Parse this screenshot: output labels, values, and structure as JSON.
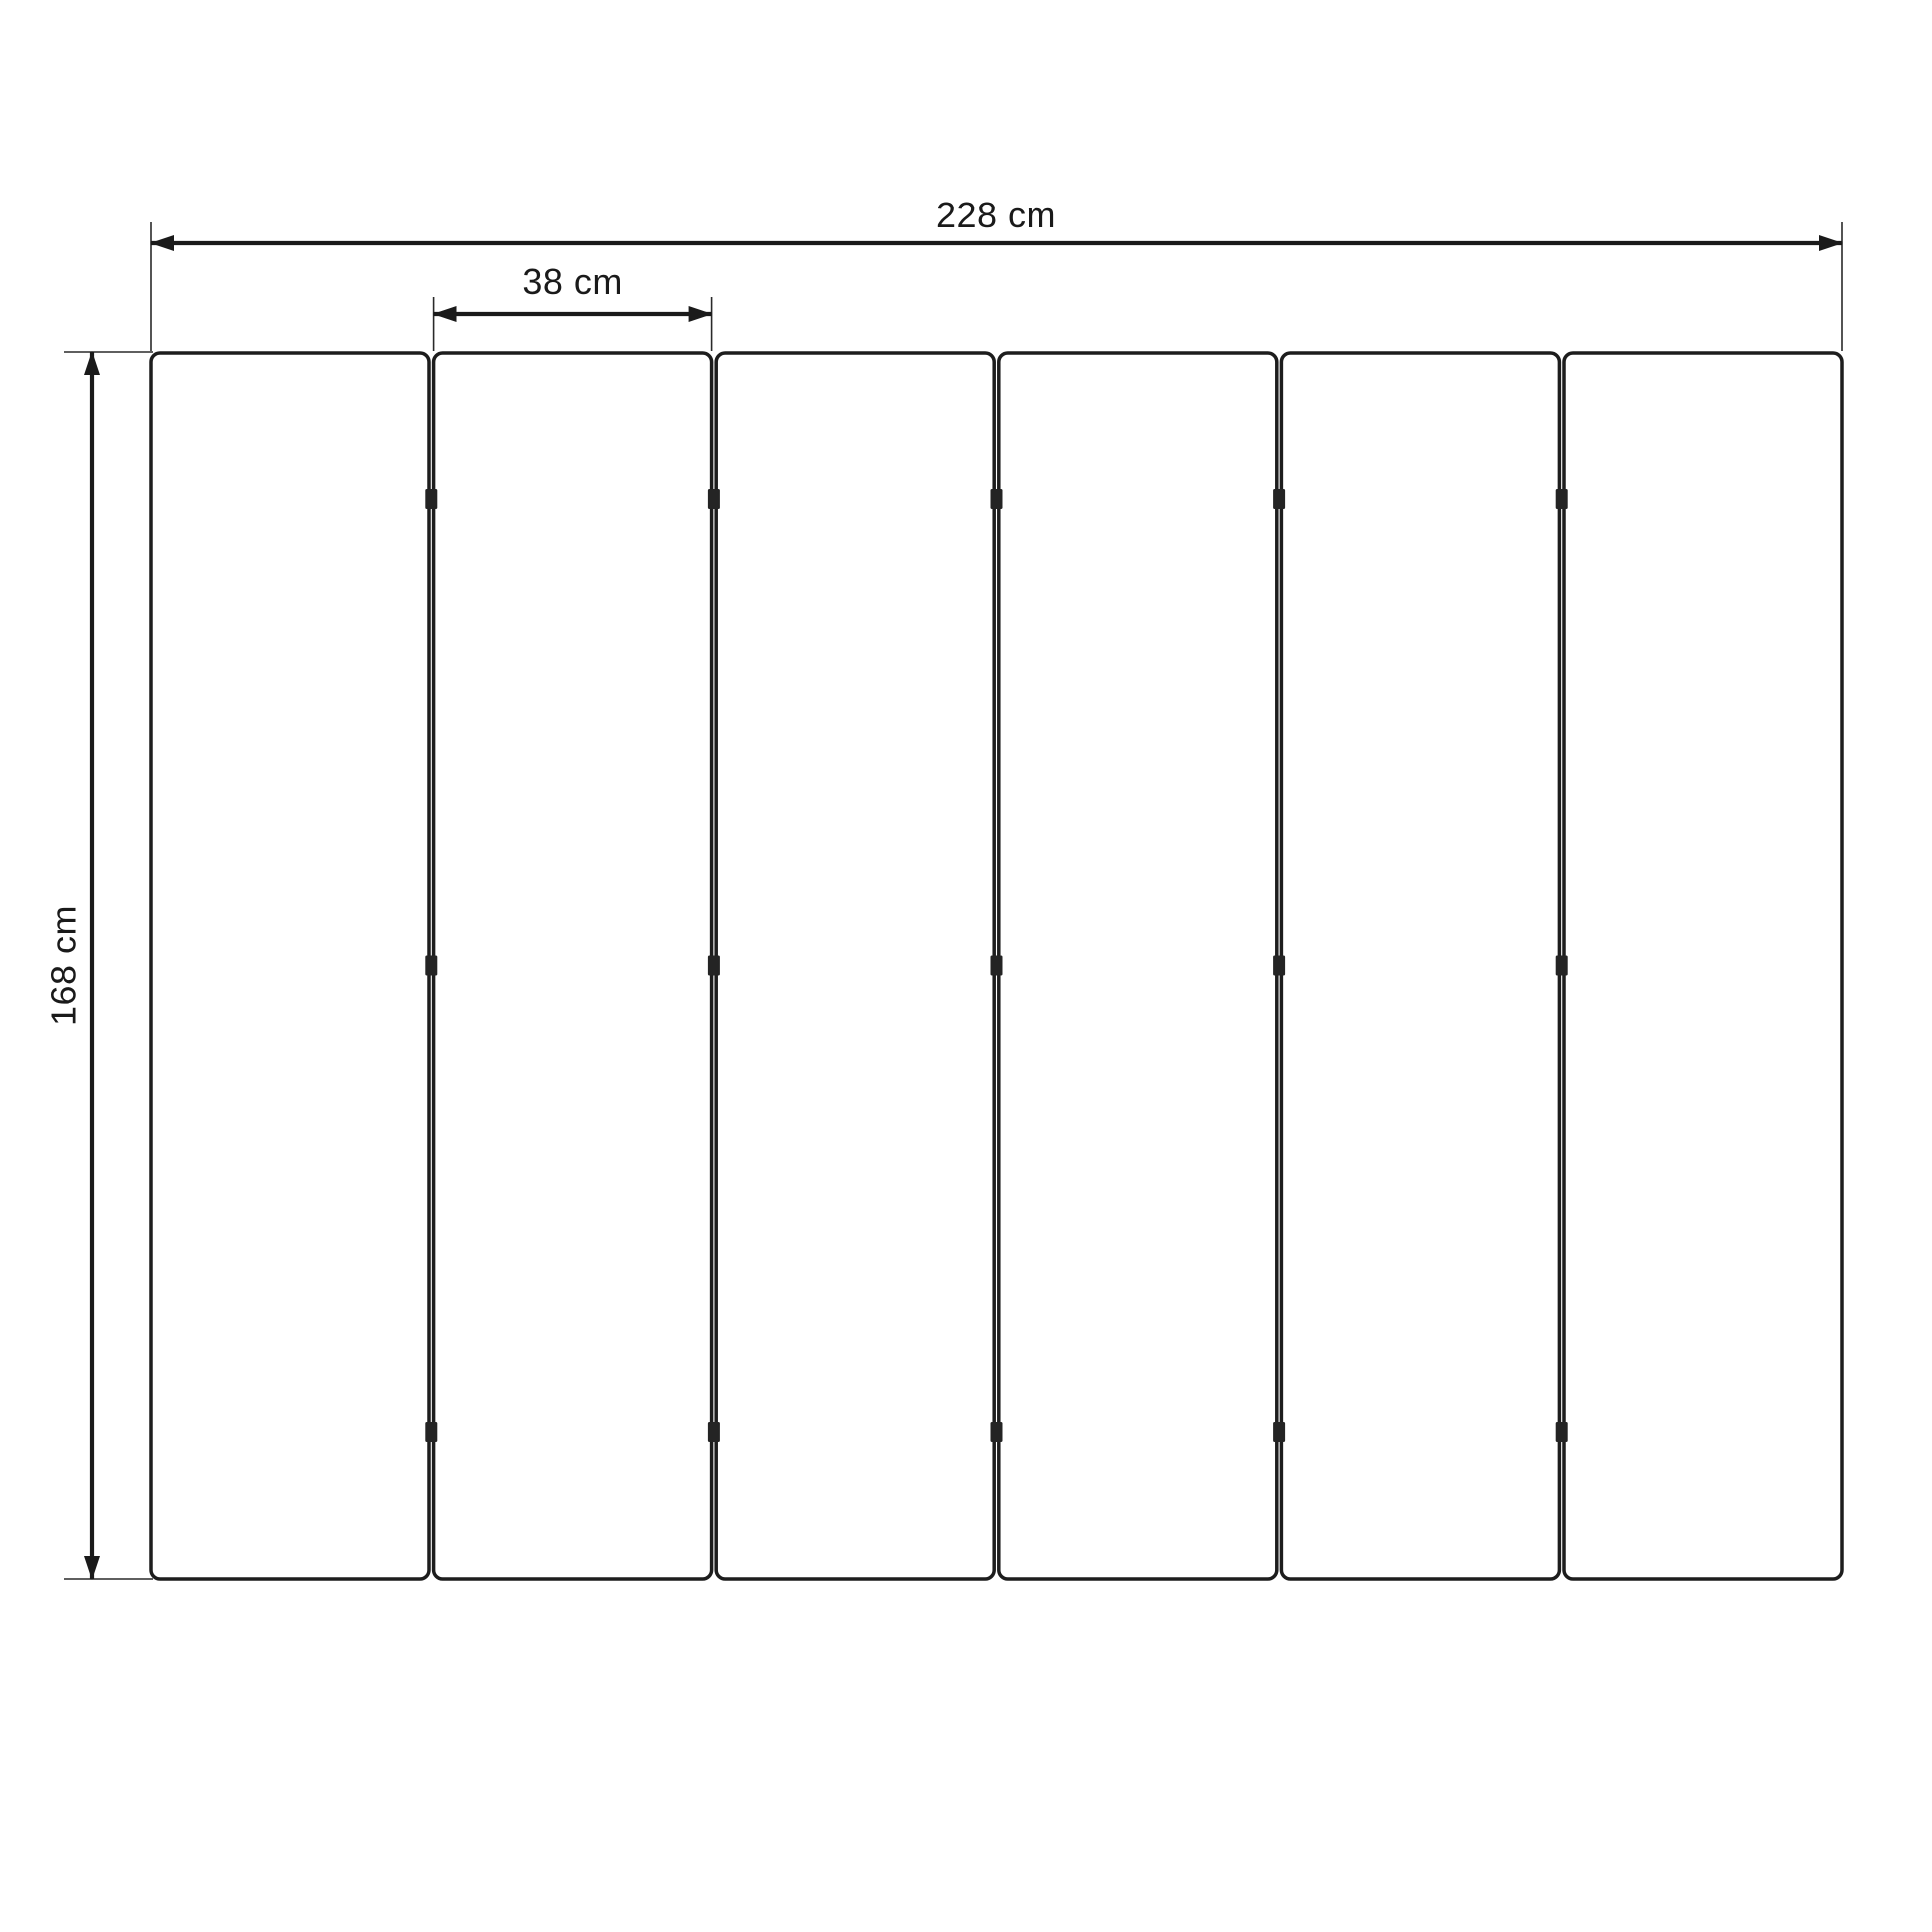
{
  "diagram": {
    "type": "panel-dimension-drawing",
    "panel_count": 6,
    "hinge_rows_per_gap": 3,
    "colors": {
      "ink": "#1a1a1a",
      "panel_border": "#1d1d1d",
      "panel_fill": "#ffffff",
      "background": "#ffffff"
    },
    "dimensions": {
      "total_width": "228 cm",
      "panel_width": "38 cm",
      "height": "168 cm"
    }
  }
}
